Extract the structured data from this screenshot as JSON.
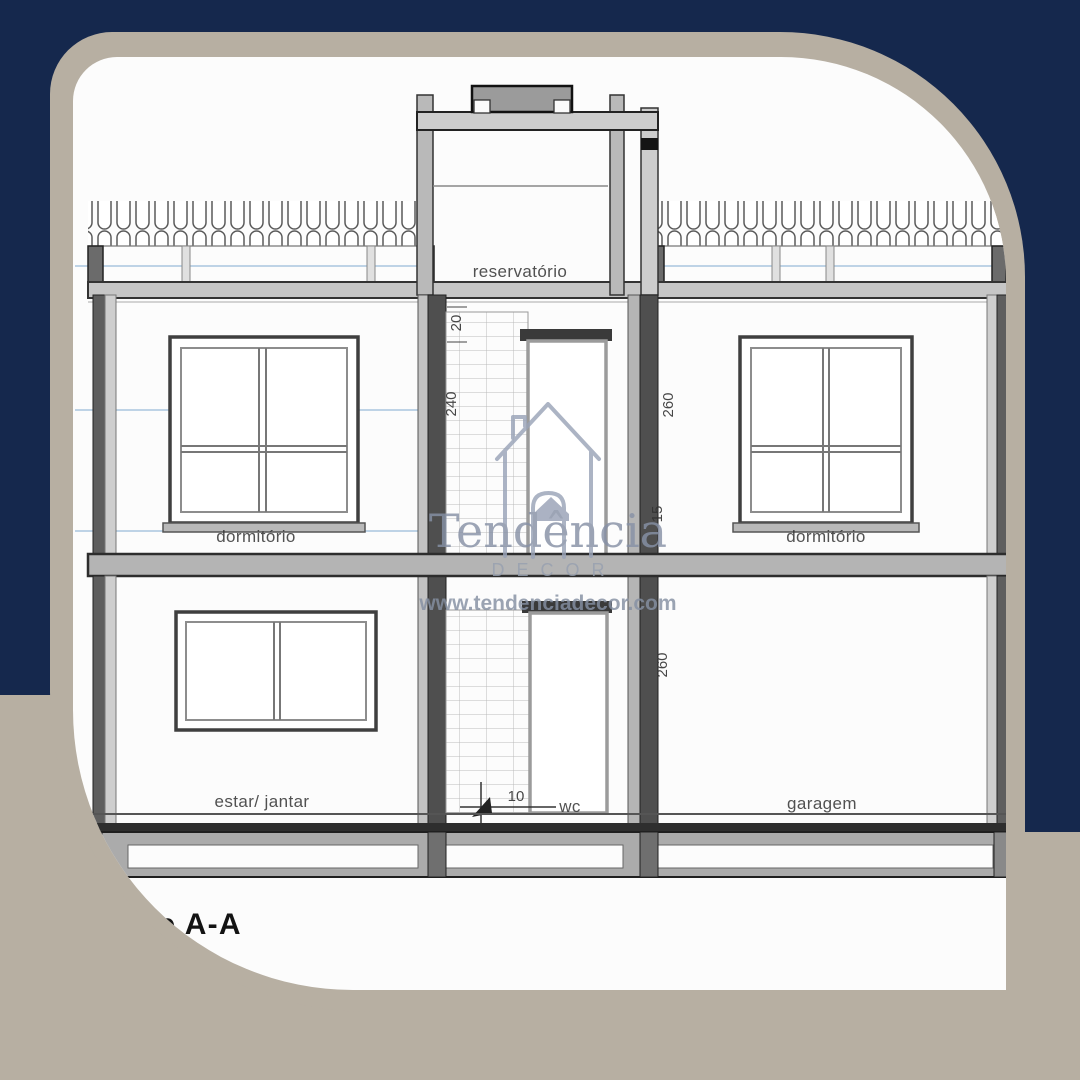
{
  "colors": {
    "navy_background": "#15284d",
    "beige_frame": "#b7afa2",
    "card_white": "#fcfcfc",
    "blueprint_level_line_blue": "#a9c5de",
    "drawing_line_dark": "#333333",
    "drawing_line_mid": "#8a8a8a",
    "drawing_fill_light": "#c6c6c6",
    "watermark_gray_blue": "#8d97ab"
  },
  "watermark": {
    "brand": "Tendência",
    "subtitle": "DECOR",
    "website": "www.tendenciadecor.com"
  },
  "drawing": {
    "title": "Corte A-A",
    "labels": {
      "tank": "reservatório",
      "bedroom_left": "dormitório",
      "bedroom_right": "dormitório",
      "living": "estar/ jantar",
      "wc": "wc",
      "garage": "garagem"
    },
    "dims": {
      "d20": "20",
      "d240": "240",
      "d260_upper": "260",
      "d15": "15",
      "d260_lower": "260",
      "d10": "10"
    }
  }
}
